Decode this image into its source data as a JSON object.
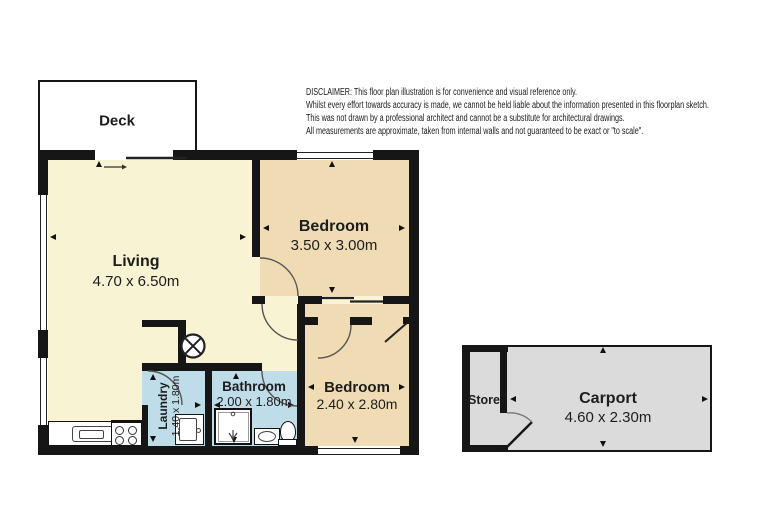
{
  "disclaimer": {
    "lines": [
      "DISCLAIMER: This floor plan illustration is for convenience and visual reference only.",
      "Whilst every effort towards accuracy is made, we cannot be held liable about the information presented in this floorplan sketch.",
      "This was not drawn by a professional architect and cannot be a substitute for architectural drawings.",
      "All measurements are approximate, taken from internal walls and not guaranteed to be exact or \"to scale\"."
    ]
  },
  "rooms": {
    "deck": {
      "name": "Deck"
    },
    "living": {
      "name": "Living",
      "dimensions": "4.70 x 6.50m"
    },
    "bedroom_main": {
      "name": "Bedroom",
      "dimensions": "3.50 x 3.00m"
    },
    "bedroom_second": {
      "name": "Bedroom",
      "dimensions": "2.40 x 2.80m"
    },
    "bathroom": {
      "name": "Bathroom",
      "dimensions": "2.00 x 1.80m"
    },
    "laundry": {
      "name": "Laundry",
      "dimensions": "1.40 x 1.80m"
    },
    "store": {
      "name": "Store"
    },
    "carport": {
      "name": "Carport",
      "dimensions": "4.60 x 2.30m"
    }
  },
  "icons": {
    "ceiling_light": "circle-cross",
    "fixtures": [
      "kitchen-sink",
      "stove-cooktop",
      "washing-machine",
      "shower",
      "vanity-basin",
      "toilet"
    ]
  },
  "colors": {
    "living": "#F8F3D2",
    "bedroom": "#EFDCB4",
    "wet_area": "#BFDDE9",
    "carport": "#DBDBDB",
    "wall": "#161616",
    "background": "#FFFFFF"
  }
}
